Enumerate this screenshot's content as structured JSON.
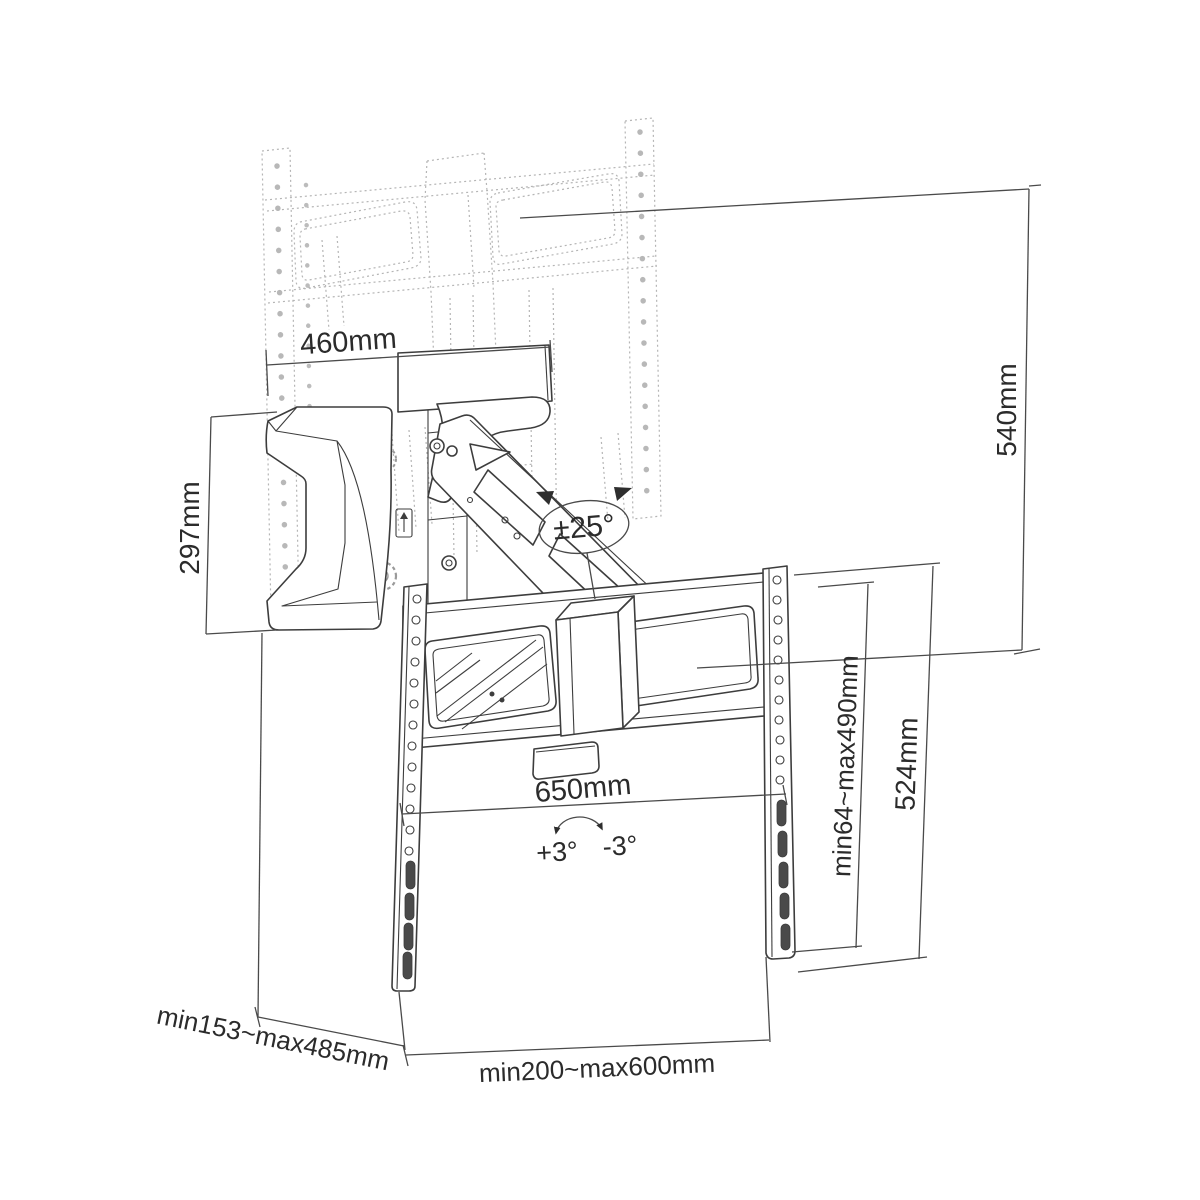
{
  "figure": {
    "dim_460": "460mm",
    "dim_540": "540mm",
    "dim_297": "297mm",
    "swivel": "±25°",
    "dim_650": "650mm",
    "tilt_plus": "+3°",
    "tilt_minus": "-3°",
    "vesa_height_range": "min64~max490mm",
    "dim_524": "524mm",
    "depth_range": "min153~max485mm",
    "vesa_width_range": "min200~max600mm"
  }
}
